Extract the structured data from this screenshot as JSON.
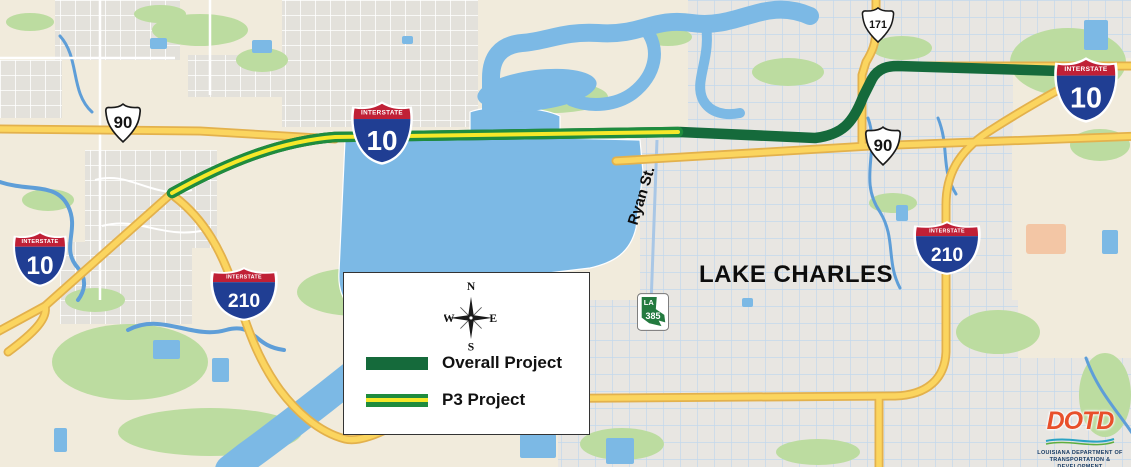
{
  "map": {
    "city_label": "LAKE CHARLES",
    "street_label": "Ryan St.",
    "colors": {
      "overall_project": "#156A3B",
      "p3_green": "#1F8C3E",
      "p3_yellow": "#F6E829",
      "highway_yellow": "#FBD55F",
      "water_blue": "#7CB9E5",
      "park_green": "#BCDCA0",
      "land_beige": "#F1EBDC",
      "interstate_red": "#C02036",
      "interstate_blue": "#203E93"
    }
  },
  "shields": {
    "interstate_banner": "INTERSTATE",
    "i10": "10",
    "i210": "210",
    "us90": "90",
    "us171": "171",
    "la_prefix": "LA",
    "la385": "385"
  },
  "legend": {
    "compass": {
      "n": "N",
      "e": "E",
      "s": "S",
      "w": "W"
    },
    "items": [
      {
        "label": "Overall Project",
        "style": "overall"
      },
      {
        "label": "P3 Project",
        "style": "p3"
      }
    ]
  },
  "logo": {
    "name": "DOTD",
    "line1": "LOUISIANA DEPARTMENT OF",
    "line2": "TRANSPORTATION & DEVELOPMENT"
  }
}
